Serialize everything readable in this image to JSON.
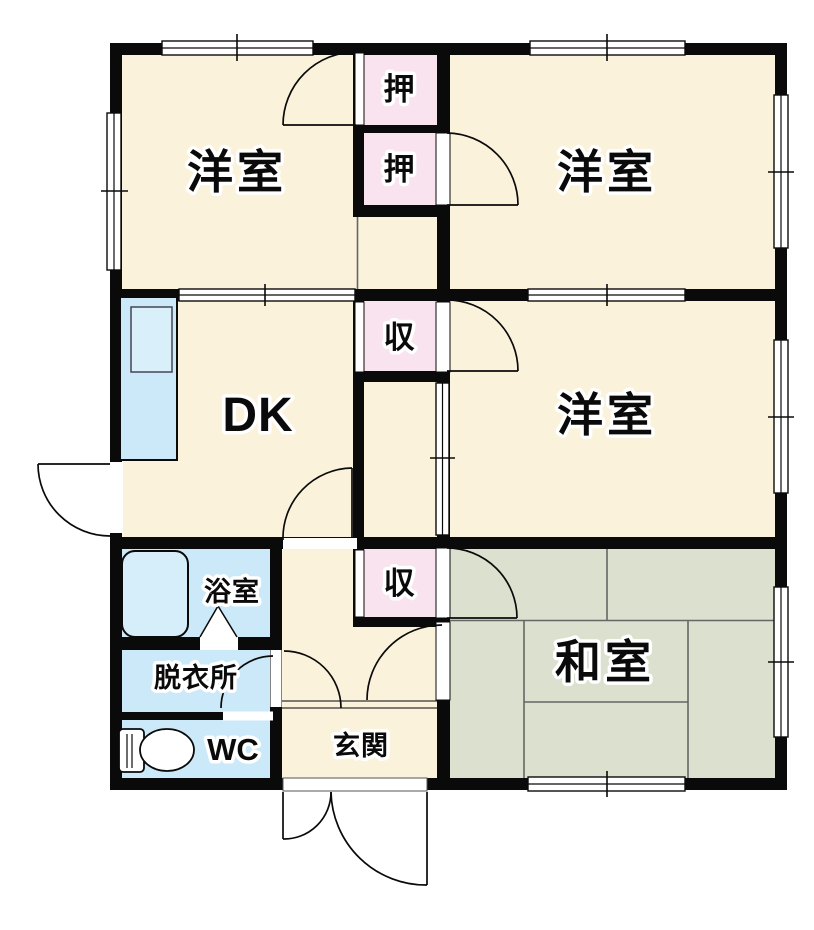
{
  "plan": {
    "type": "japanese-apartment-floor-plan",
    "rooms": {
      "western_room_top_left": {
        "label": "洋室"
      },
      "western_room_top_right": {
        "label": "洋室"
      },
      "western_room_middle": {
        "label": "洋室"
      },
      "dining_kitchen": {
        "label": "DK"
      },
      "japanese_room": {
        "label": "和室"
      },
      "bathroom": {
        "label": "浴室"
      },
      "dressing_room": {
        "label": "脱衣所"
      },
      "toilet": {
        "label": "WC"
      },
      "entrance": {
        "label": "玄関"
      },
      "closet_upper_1": {
        "label": "押"
      },
      "closet_upper_2": {
        "label": "押"
      },
      "storage_mid": {
        "label": "収"
      },
      "storage_lower": {
        "label": "収"
      }
    },
    "fixtures": {
      "kitchen_counter": "kitchen-counter-with-sink",
      "bathtub": "bathtub",
      "toilet_bowl": "toilet-bowl",
      "bath_folding_door": "folding-door-triangle"
    },
    "colors": {
      "room_cream": "#FBF2DB",
      "closet_pink": "#F9E3EF",
      "wet_area_blue": "#CBE9F8",
      "tatami_green": "#DBE1CE",
      "wall_black": "#0a0a0a",
      "thin_line_gray": "#555555"
    }
  }
}
